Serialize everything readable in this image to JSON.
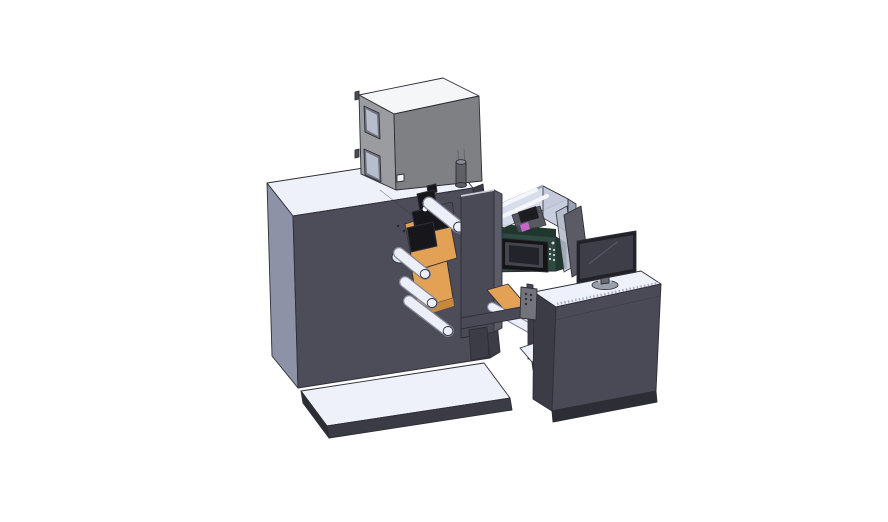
{
  "scene": {
    "description": "Isometric 3D CAD render of a compact label printing press: large unwind cabinet with dryer box on top, central print-head column with web rollers and orange guide plates, glass-covered print unit with green control panel and touchscreen, connected by a bridge to an operator desk with a monitor, splash guards and a hanging pendant control.",
    "background": "#ffffff"
  },
  "colors": {
    "top_white": "#eef1fa",
    "top_shade": "#dde3f0",
    "cabinet_front": "#4d4d59",
    "cabinet_side": "#8d92a6",
    "cabinet_right": "#3c3c46",
    "platform_side": "#3b3b46",
    "base_dark": "#2d2d36",
    "box_top": "#f5f6f8",
    "box_left": "#9b9c9f",
    "box_front": "#7f8084",
    "box_window_frame": "#6f7480",
    "box_window": "#b7bdcb",
    "knob": "#5f5f66",
    "knob_top": "#8a8a92",
    "orange": "#e3a156",
    "orange_dark": "#c8883e",
    "roller": "#eceff7",
    "mech_black": "#17171b",
    "mech_gray": "#4a4b54",
    "tower_front": "#4a4a56",
    "tower_side": "#5c5c68",
    "green_front": "#2d4b40",
    "green_dark": "#1e382e",
    "screen_bezel": "#141417",
    "screen_frame": "#43444c",
    "screen_face": "#23232b",
    "glass": "#d6dcea",
    "glass_wall": "#c2c9da",
    "glass_frame": "#9aa2b5",
    "magenta": "#c368c9",
    "monitor_bezel": "#212127",
    "monitor_screen": "#3e3e49",
    "stand": "#99a0ad",
    "stand_light": "#b4bac6",
    "neck": "#6a6a74",
    "pendant": "#73737c",
    "pendant_dot": "#2f2f37",
    "desk_front": "#4a4a56",
    "side_glass": "#5b5b66",
    "side_glass_light": "#b3bac8",
    "white_detail": "#f2f3f7",
    "vent_dot": "#cfd6df"
  },
  "parts": {
    "unwind_cabinet": "unwind-cabinet",
    "dryer_box": "dryer-box",
    "print_head": "print-head",
    "web_rollers": "web-rollers",
    "print_unit": "glass-print-unit",
    "control_panel": "control-panel-touchscreen",
    "center_column": "center-column",
    "bridge": "outfeed-bridge",
    "pendant": "pendant-control",
    "desk": "operator-desk",
    "monitor": "desk-monitor",
    "base_platform": "base-platform"
  }
}
